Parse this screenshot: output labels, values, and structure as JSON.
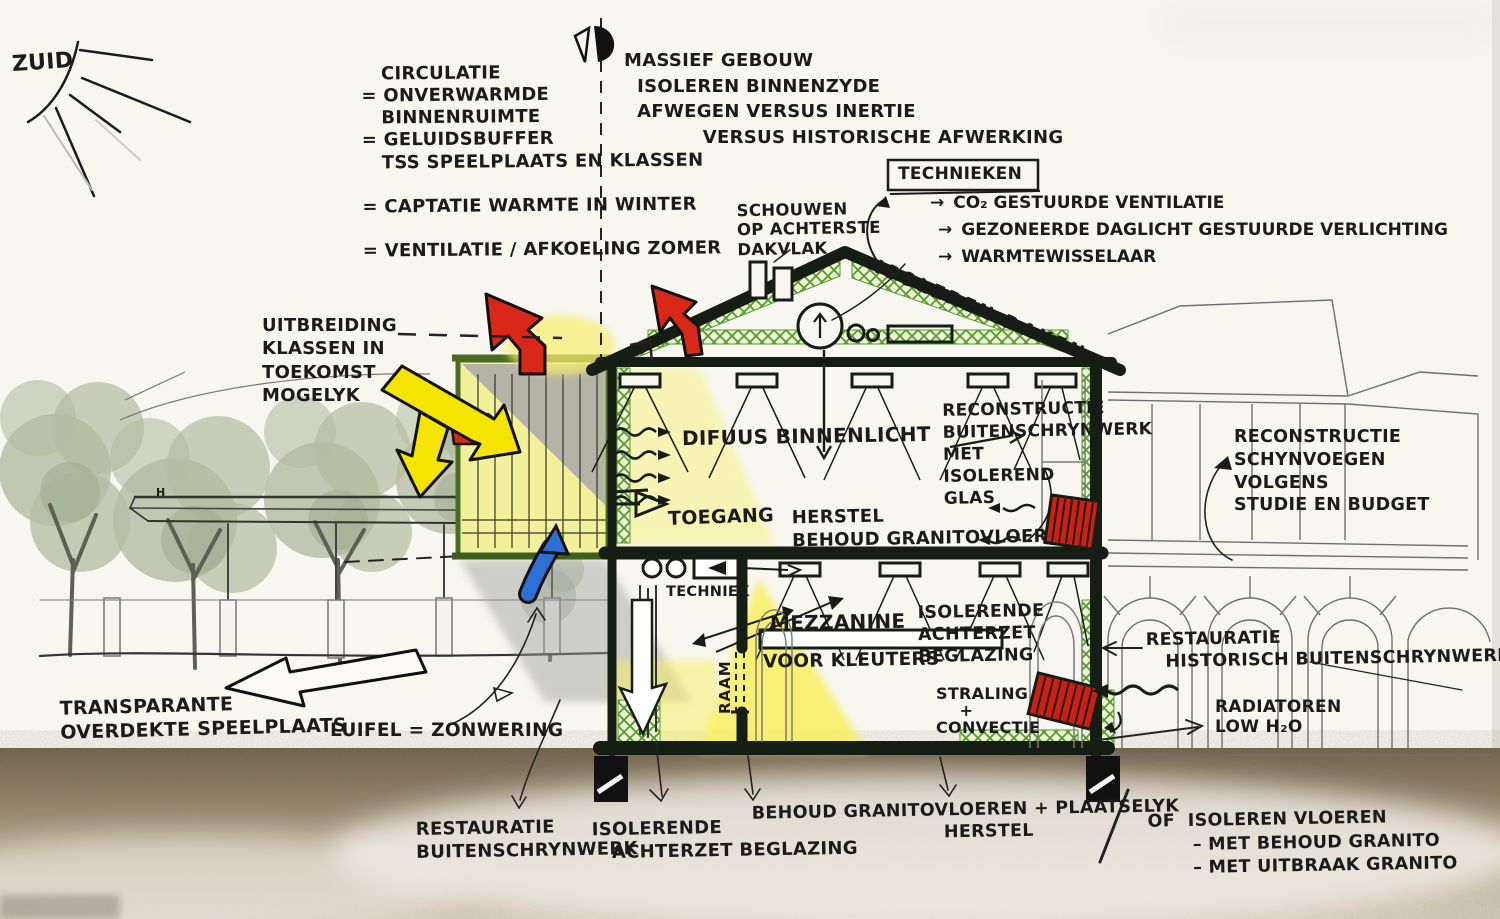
{
  "title": "Schetsontwerp doorsnede school - duurzaamheidsconcept",
  "glyphs": {
    "arrow": "→"
  },
  "colors": {
    "ink": "#1b1b1b",
    "insulation_green": "#569a2c",
    "frame_dark": "#161d14",
    "arrow_red": "#d8281a",
    "arrow_yellow": "#f4e400",
    "arrow_blue": "#2e6fd6",
    "radiator_red": "#cf1f10",
    "light_yellow": "#f7f283",
    "ground_brown": "#8d7d65",
    "tree_green": "#a7b292",
    "paper": "#f7f6f1"
  },
  "sun": {
    "label": "ZUID"
  },
  "notes": {
    "circulatie": "   CIRCULATIE\n= ONVERWARMDE\n   BINNENRUIMTE\n= GELUIDSBUFFER\n   TSS SPEELPLAATS EN KLASSEN\n\n= CAPTATIE WARMTE IN WINTER\n\n= VENTILATIE / AFKOELING ZOMER",
    "massief": "MASSIEF GEBOUW\n  ISOLEREN BINNENZYDE\n  AFWEGEN VERSUS INERTIE\n            VERSUS HISTORISCHE AFWERKING"
  },
  "technieken": {
    "title": "TECHNIEKEN",
    "items": [
      "CO₂ GESTUURDE VENTILATIE",
      "GEZONEERDE DAGLICHT GESTUURDE VERLICHTING",
      "WARMTEWISSELAAR"
    ]
  },
  "roof": {
    "schouwen": "SCHOUWEN\nOP ACHTERSTE\nDAKVLAK",
    "isoleren_daken": "ISOLEREN DAKEN"
  },
  "left": {
    "uitbreiding": "UITBREIDING\nKLASSEN IN\nTOEKOMST\nMOGELYK",
    "transparante": "TRANSPARANTE\nOVERDEKTE SPEELPLAATS",
    "luifel": "LUIFEL = ZONWERING",
    "h_marker": "H"
  },
  "interior": {
    "difuus": "DIFUUS BINNENLICHT",
    "toegang": "TOEGANG",
    "herstel": "HERSTEL\nBEHOUD GRANITOVLOER",
    "techniek": "TECHNIEK",
    "mezzanine": "MEZZANINE",
    "voor_kleuters": "VOOR KLEUTERS",
    "raam": "RAAM",
    "isolerende_achterzet": "ISOLERENDE\nACHTERZET\nBEGLAZING",
    "straling": "STRALING\n    +\nCONVECTIE"
  },
  "right": {
    "reconstructie_buitenschrijnwerk": "RECONSTRUCTIE\nBUITENSCHRYNWERK\nMET\nISOLEREND\nGLAS",
    "reconstructie_schijnvoegen": "RECONSTRUCTIE\nSCHYNVOEGEN\nVOLGENS\nSTUDIE EN BUDGET",
    "restauratie_historisch": "RESTAURATIE\n   HISTORISCH BUITENSCHRYNWERK",
    "radiatoren": "RADIATOREN\nLOW H₂O"
  },
  "bottom": {
    "restauratie_buitenschrijnwerk": "RESTAURATIE\nBUITENSCHRYNWERK",
    "isolerende_achterzetbeglazing": "ISOLERENDE\n   ACHTERZET BEGLAZING",
    "behoud_granito": "BEHOUD GRANITOVLOEREN + PLAATSELYK\n                              HERSTEL",
    "of_isoleren": "OF  ISOLEREN VLOEREN\n       – MET BEHOUD GRANITO\n       – MET UITBRAAK GRANITO"
  }
}
